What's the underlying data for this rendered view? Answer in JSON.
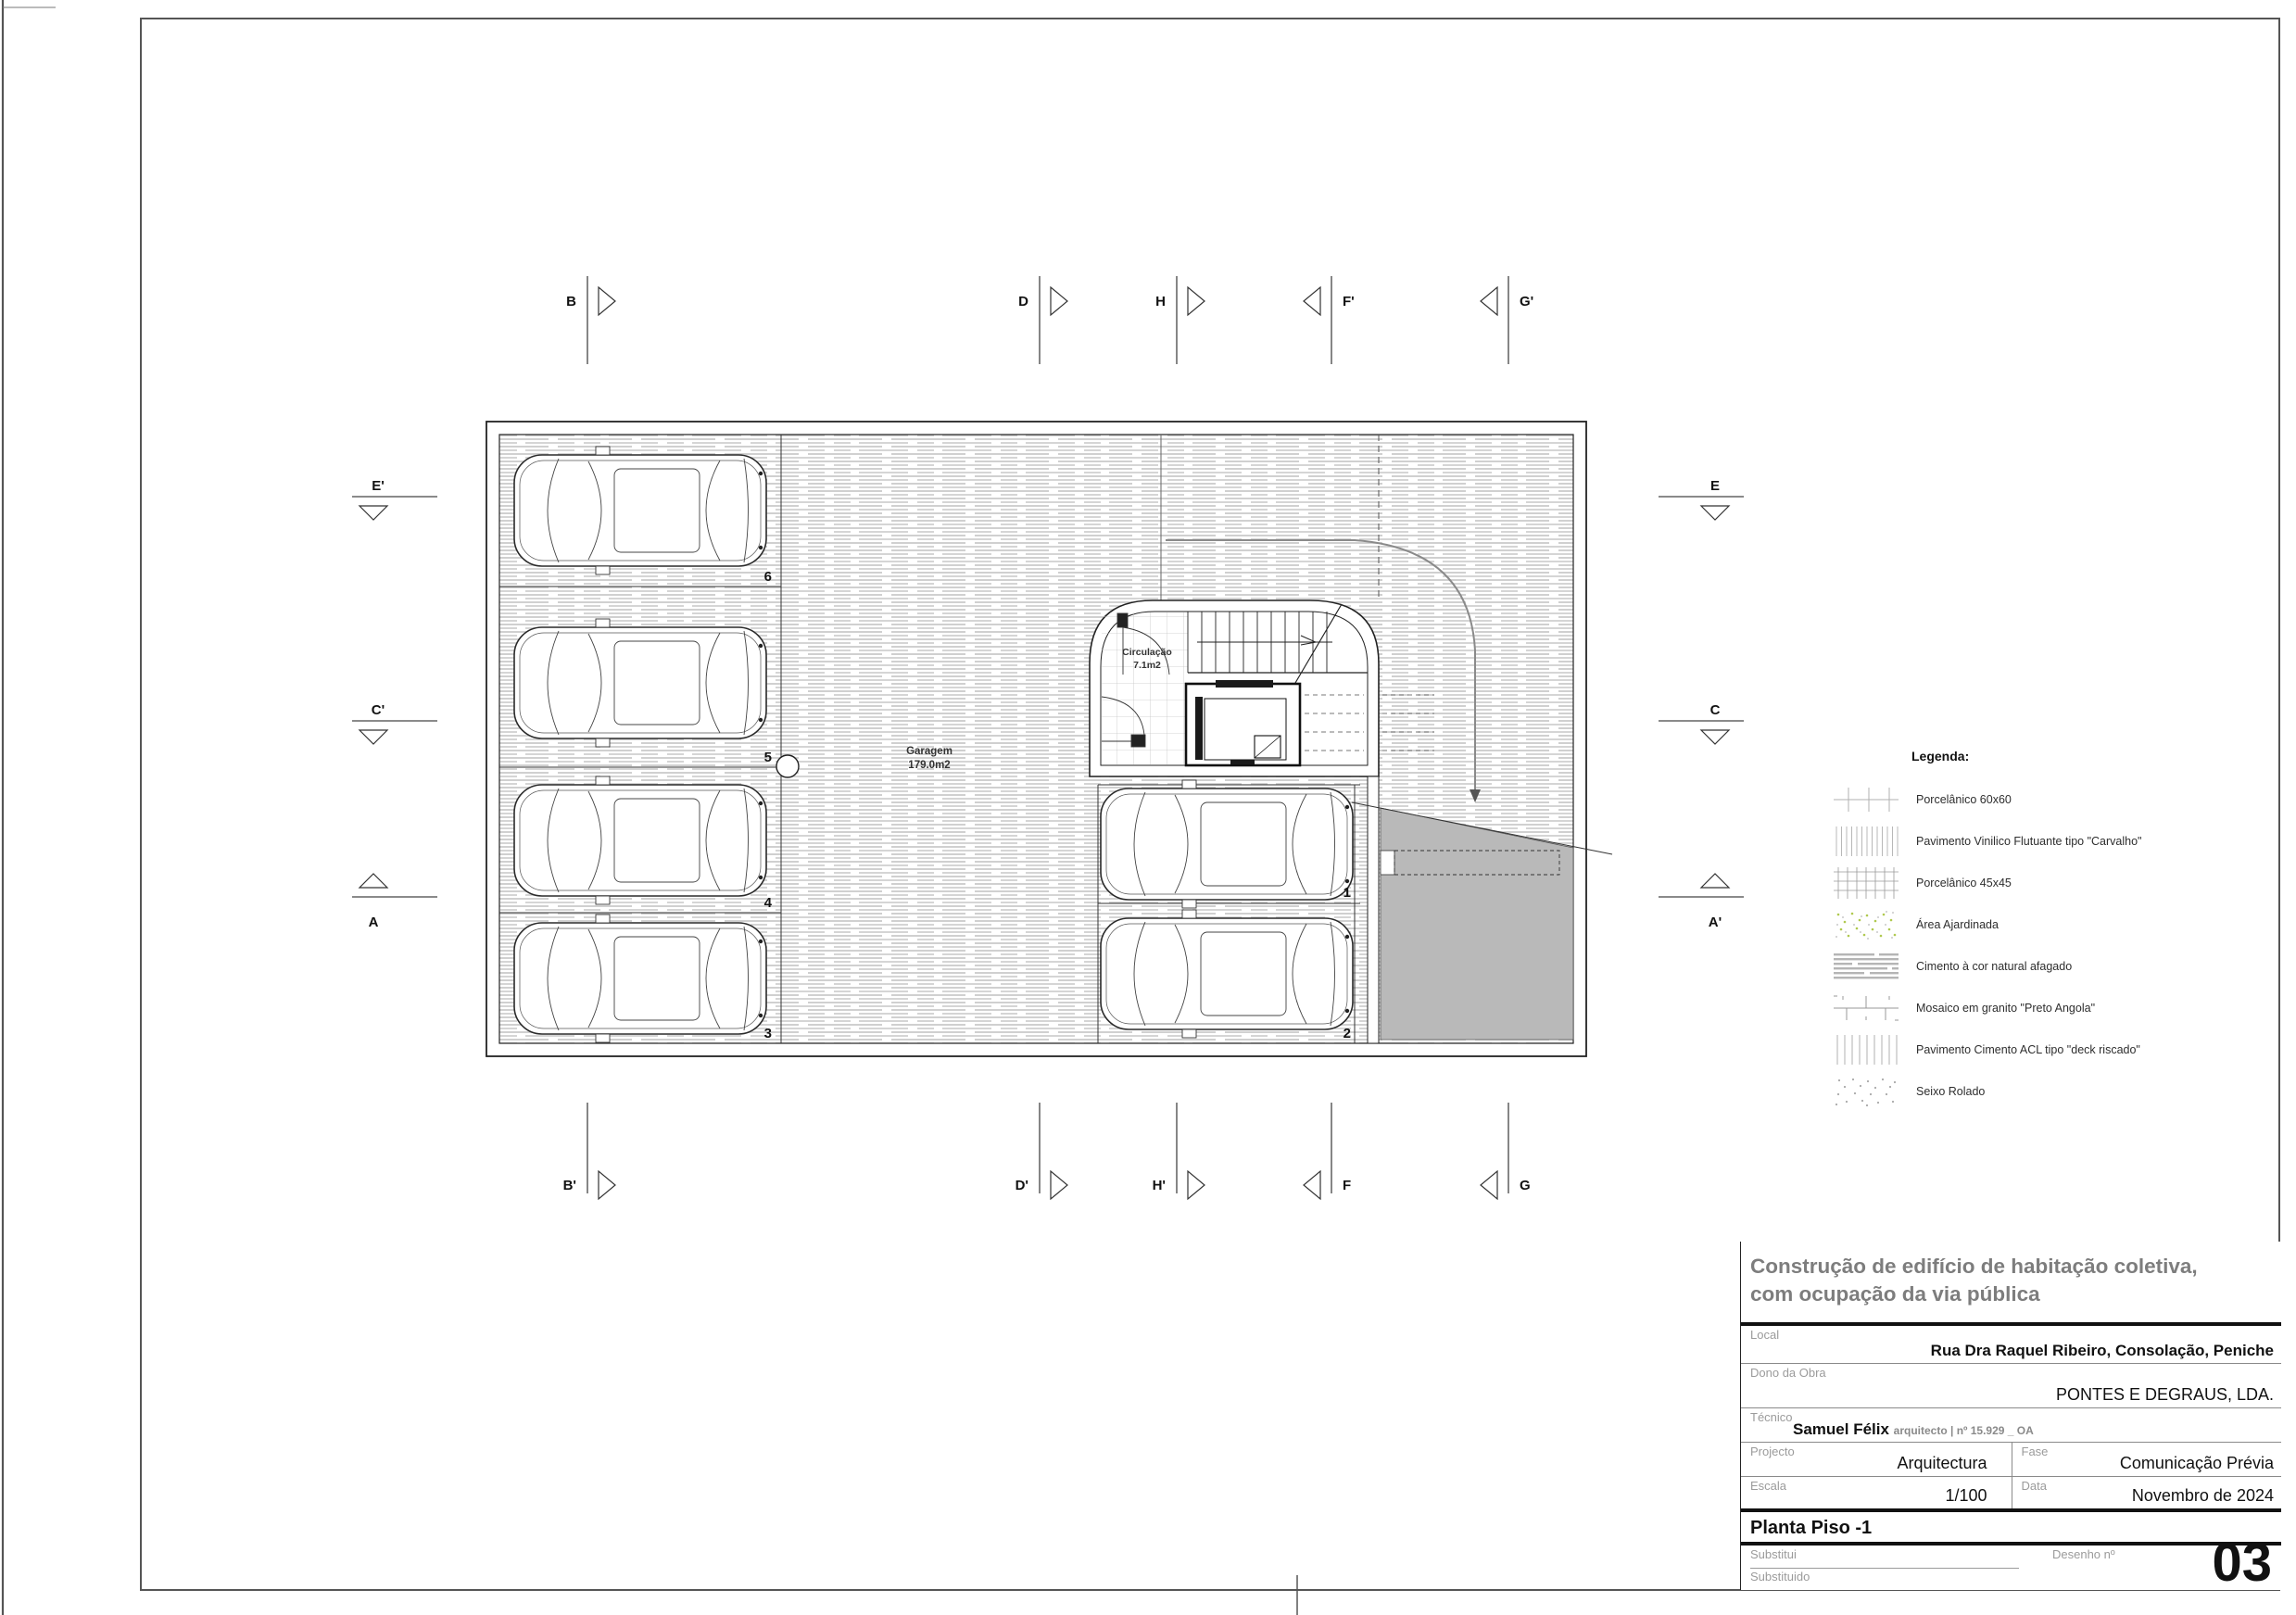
{
  "plan": {
    "garage": {
      "name": "Garagem",
      "area": "179.0m2"
    },
    "circulation": {
      "name": "Circulação",
      "area": "7.1m2"
    },
    "stalls": {
      "left": [
        "6",
        "5",
        "4",
        "3"
      ],
      "right": [
        "1",
        "2"
      ]
    },
    "markers": {
      "top": [
        "B",
        "D",
        "H",
        "F'",
        "G'"
      ],
      "bottom": [
        "B'",
        "D'",
        "H'",
        "F",
        "G"
      ],
      "left": [
        "E'",
        "C'",
        "A"
      ],
      "right": [
        "E",
        "C",
        "A'"
      ]
    }
  },
  "legend": {
    "title": "Legenda:",
    "items": [
      {
        "label": "Porcelânico 60x60",
        "swatch": "porcelanico-60x60"
      },
      {
        "label": "Pavimento Vinilico Flutuante tipo \"Carvalho\"",
        "swatch": "vinilico-carvalho"
      },
      {
        "label": "Porcelânico 45x45",
        "swatch": "porcelanico-45x45"
      },
      {
        "label": "Área Ajardinada",
        "swatch": "area-ajardinada"
      },
      {
        "label": "Cimento à cor natural afagado",
        "swatch": "cimento-afagado"
      },
      {
        "label": "Mosaico em granito \"Preto Angola\"",
        "swatch": "mosaico-granito"
      },
      {
        "label": "Pavimento Cimento ACL tipo \"deck riscado\"",
        "swatch": "cimento-acl-deck"
      },
      {
        "label": "Seixo Rolado",
        "swatch": "seixo-rolado"
      }
    ]
  },
  "title_block": {
    "project_title_line1": "Construção de edifício de habitação coletiva,",
    "project_title_line2": "com ocupação da via pública",
    "local_label": "Local",
    "local_value": "Rua Dra Raquel Ribeiro, Consolação, Peniche",
    "dono_label": "Dono da Obra",
    "dono_value": "PONTES E DEGRAUS, LDA.",
    "tecnico_label": "Técnico",
    "tecnico_value": "Samuel Félix",
    "tecnico_suffix": "arquitecto | nº 15.929 _ OA",
    "projecto_label": "Projecto",
    "projecto_value": "Arquitectura",
    "fase_label": "Fase",
    "fase_value": "Comunicação Prévia",
    "escala_label": "Escala",
    "escala_value": "1/100",
    "data_label": "Data",
    "data_value": "Novembro de 2024",
    "drawing_title": "Planta Piso -1",
    "substitui_label": "Substitui",
    "substituido_label": "Substituido",
    "desenho_label": "Desenho nº",
    "drawing_number": "03"
  },
  "colors": {
    "ramp_gray": "#b9b9b9",
    "floor_stripe": "#c9c9c9",
    "title_gray": "#7d7d7d",
    "garden_green": "#b0c94f"
  }
}
